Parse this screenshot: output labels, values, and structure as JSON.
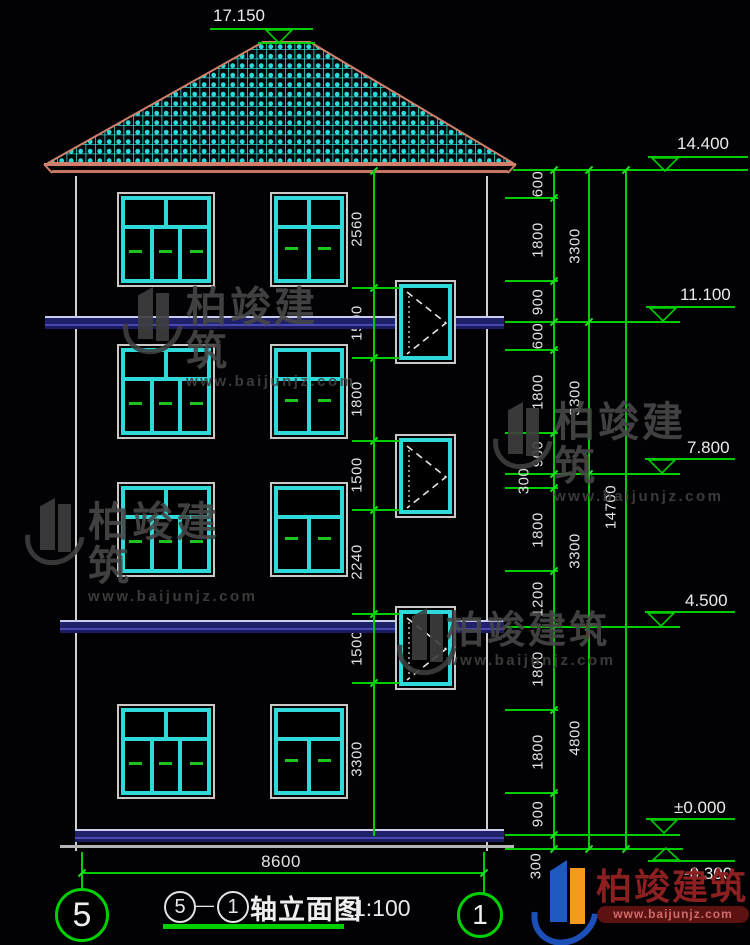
{
  "drawing": {
    "peak_elevation": "17.150",
    "elevations": {
      "eave": "14.400",
      "f4": "11.100",
      "f3": "7.800",
      "f2": "4.500",
      "ground": "±0.000",
      "base": "-0.300"
    },
    "left_chain": [
      "2560",
      "1500",
      "1800",
      "1500",
      "2240",
      "1500",
      "3300"
    ],
    "right_chain_1": [
      "600",
      "1800",
      "900",
      "600",
      "1800",
      "900",
      "300",
      "1800",
      "1200",
      "1800",
      "1800",
      "900",
      "300"
    ],
    "right_chain_2": [
      "3300",
      "3300",
      "3300",
      "4800"
    ],
    "right_total": "14700",
    "bottom_width": "8600",
    "grid_bubbles": {
      "left": "5",
      "right": "1"
    },
    "title": {
      "axis_start": "5",
      "separator": "—",
      "axis_end": "1",
      "name": "轴立面图",
      "scale": "1:100"
    }
  },
  "watermark": {
    "label": "柏竣建筑",
    "url": "www.baijunjz.com"
  },
  "logo": {
    "label": "柏竣建筑",
    "url": "www.baijunjz.com"
  },
  "colors": {
    "dim_green": "#00cd00",
    "frame_cyan": "#2fd9d9",
    "roof_salmon": "#d0806c",
    "slab_navy": "#20206b"
  }
}
